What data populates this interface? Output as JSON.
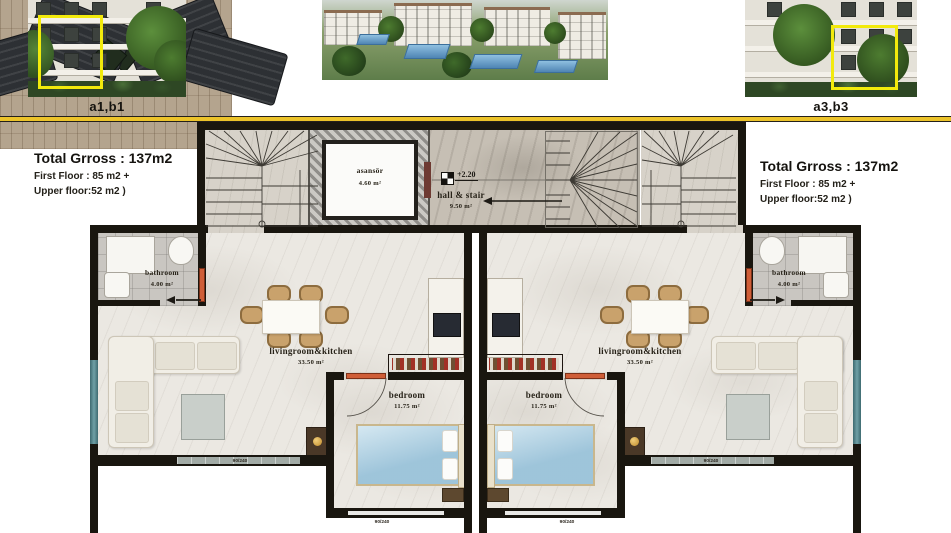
{
  "header": {
    "thumb_left_label": "a1,b1",
    "thumb_right_label": "a3,b3"
  },
  "info_left": {
    "title": "Total Grross : 137m2",
    "line1": "First Floor : 85 m2 +",
    "line2": "Upper floor:52 m2 )"
  },
  "info_right": {
    "title": "Total Grross : 137m2",
    "line1": "First Floor : 85 m2 +",
    "line2": "Upper floor:52 m2 )"
  },
  "plan": {
    "elevator": {
      "label": "asansör",
      "area": "4.60 m²"
    },
    "hall": {
      "label": "hall & stair",
      "area": "9.50 m²",
      "level": "+2.20"
    },
    "bathroom_left": {
      "label": "bathroom",
      "area": "4.00 m²"
    },
    "bathroom_right": {
      "label": "bathroom",
      "area": "4.00 m²"
    },
    "living_left": {
      "label": "livingroom&kitchen",
      "area": "33.50 m²"
    },
    "living_right": {
      "label": "livingroom&kitchen",
      "area": "33.50 m²"
    },
    "bedroom_left": {
      "label": "bedroom",
      "area": "11.75 m²"
    },
    "bedroom_right": {
      "label": "bedroom",
      "area": "11.75 m²"
    },
    "window_dim": "90/240"
  },
  "colors": {
    "divider_yellow": "#ecc32a",
    "highlight_yellow": "#f2ea0c",
    "wall_black": "#19160f",
    "door_orange": "#cf5e38",
    "bed_blue": "#abd1e4"
  }
}
